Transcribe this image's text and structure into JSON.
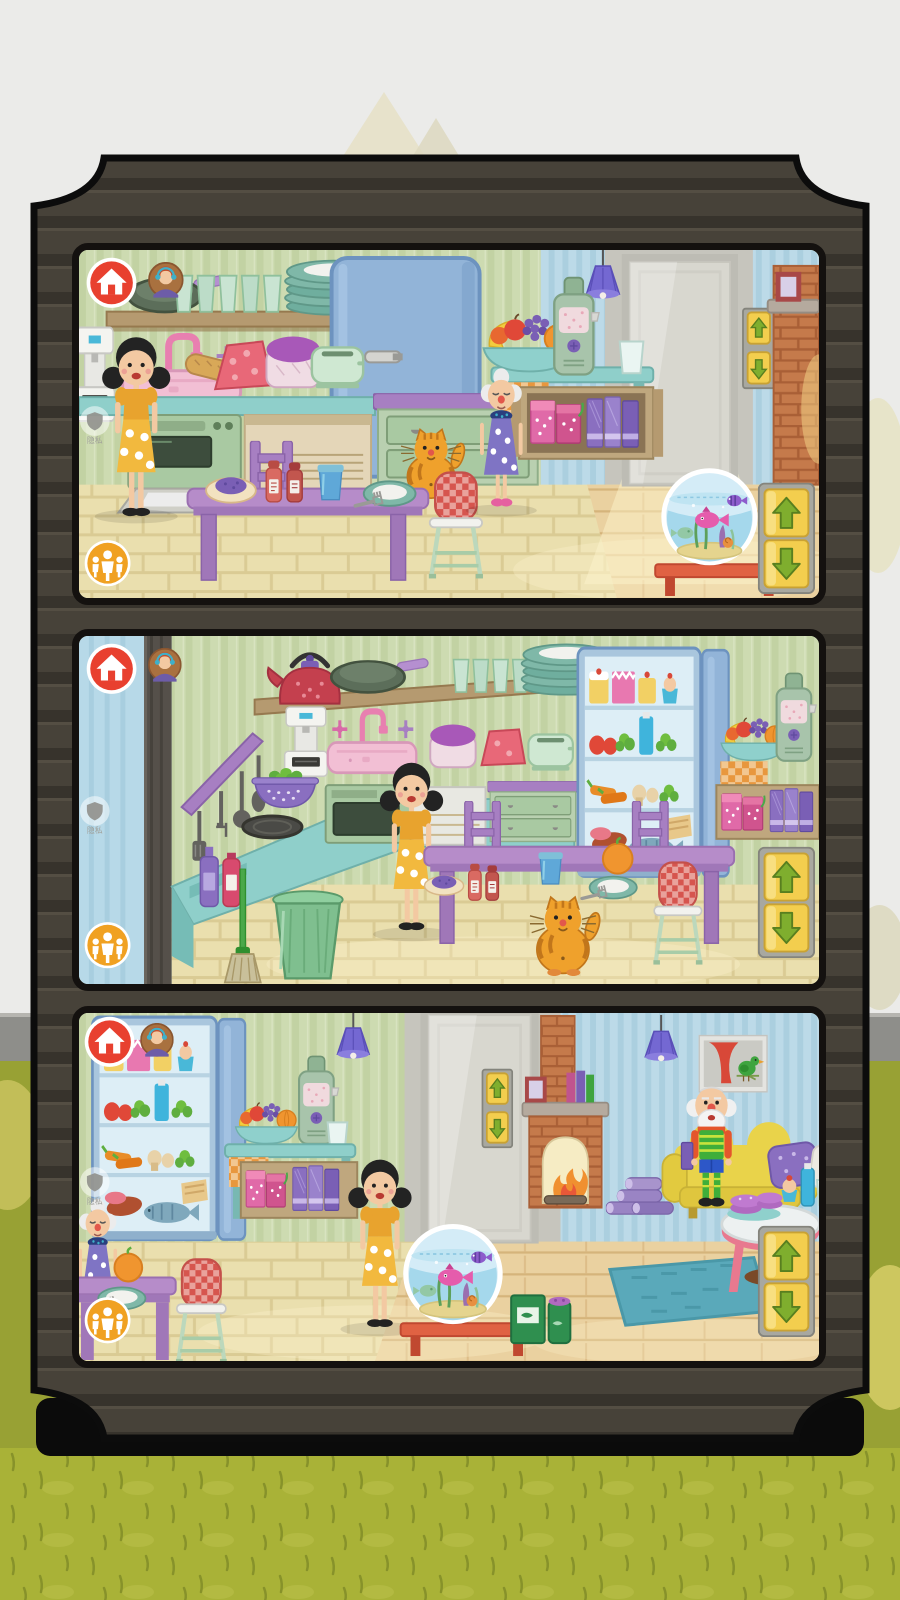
{
  "privacy_widget": {
    "label": "隐私",
    "icon": "shield-icon"
  },
  "ui": {
    "home_button": {
      "icon": "home-icon",
      "color": "#e8402f"
    },
    "parent_avatar": {
      "icon": "parent-avatar-icon"
    },
    "family_button": {
      "icon": "family-icon",
      "color": "#f0a122"
    },
    "elevator": {
      "up_icon": "arrow-up-icon",
      "down_icon": "arrow-down-icon",
      "button_color": "#f3ce4e",
      "arrow_color": "#7fae2e"
    }
  },
  "palette": {
    "background": "#ebebe9",
    "horizon_band": "#8e8e8a",
    "grass": "#a9b237",
    "grass_blade": "#87922a",
    "frame": "#474239",
    "frame_stripe": "#37332c",
    "wall_green": "#cddbb1",
    "wall_blue": "#bcdae8",
    "door_gray": "#d8d7cf",
    "floor_tile": "#eadfae",
    "floor_wood": "#ead1a0",
    "fridge_blue": "#92b4d8",
    "counter_teal": "#8fcfca",
    "cabinet_green": "#a9c9a2",
    "trim_purple": "#a77fc2",
    "table_purple": "#b68cc9",
    "sink_pink": "#f2bfd4",
    "dress_yellow": "#f2b93e",
    "skin": "#f3c9a2",
    "cat_orange": "#efa12c",
    "couch_yellow": "#e9d34a",
    "rug_teal": "#5aa9ba",
    "brick": "#c57a4b",
    "lamp_purple": "#7468d2",
    "bench_red": "#e06243",
    "water_blue": "#a5d8ec"
  },
  "panel_count": 3,
  "panels": [
    {
      "id": "panel-1",
      "scene": "kitchen-dining",
      "characters": [
        "mom",
        "grandma",
        "cat"
      ],
      "objects": [
        "home-button",
        "parent-avatar",
        "frying-pan",
        "shelf-glasses",
        "shelf-plates",
        "refrigerator-closed",
        "coffee-machine",
        "sink",
        "baguette",
        "ham",
        "bread-loaf",
        "toaster",
        "oven-open",
        "drawers",
        "dining-table",
        "toast-with-jam",
        "salt-pepper-shakers",
        "cup",
        "plate-with-fork",
        "chair",
        "high-chair",
        "fruit-bowl",
        "juicer",
        "drinking-glass",
        "cabinet-jams-books",
        "ceiling-lamp",
        "door",
        "elevator-buttons",
        "fireplace",
        "fish-bowl",
        "elevator-panel",
        "family-button",
        "privacy-widget"
      ]
    },
    {
      "id": "panel-2",
      "scene": "kitchen-wide",
      "characters": [
        "mom",
        "cat"
      ],
      "objects": [
        "home-button",
        "parent-avatar",
        "utensil-rack",
        "kettle",
        "frying-pan",
        "shelf-glasses",
        "shelf-plates",
        "coffee-machine",
        "colander",
        "stove-burner",
        "sink",
        "bread-loaf",
        "ham",
        "toaster",
        "oven",
        "drawers",
        "bottles",
        "broom",
        "trash-can",
        "refrigerator-open",
        "fridge-cakes",
        "fridge-vegetables",
        "fridge-meat-fish",
        "fruit-bowl",
        "juicer",
        "cabinet-jams-books",
        "dining-table",
        "chairs",
        "toast-with-jam",
        "salt-pepper-shakers",
        "cup",
        "orange",
        "plate-with-fork",
        "high-chair",
        "elevator-panel",
        "family-button",
        "privacy-widget"
      ]
    },
    {
      "id": "panel-3",
      "scene": "kitchen-living-room",
      "characters": [
        "mom",
        "grandma",
        "grandpa"
      ],
      "objects": [
        "home-button",
        "parent-avatar",
        "refrigerator-open",
        "fridge-cakes",
        "fridge-vegetables",
        "fridge-meat-fish",
        "grandma-table",
        "orange",
        "plate-with-fork",
        "high-chair",
        "fruit-bowl",
        "juicer",
        "drinking-glass",
        "cabinet-jams-books",
        "ceiling-lamps",
        "door",
        "elevator-buttons",
        "fireplace",
        "mantel-photo",
        "mantel-books",
        "firewood-logs",
        "wall-picture",
        "sofa",
        "pillows",
        "grandpa-with-book",
        "coffee-table",
        "macarons",
        "cupcake",
        "bottle",
        "rug",
        "fish-bowl",
        "fish-food",
        "elevator-panel",
        "family-button",
        "privacy-widget"
      ]
    }
  ]
}
